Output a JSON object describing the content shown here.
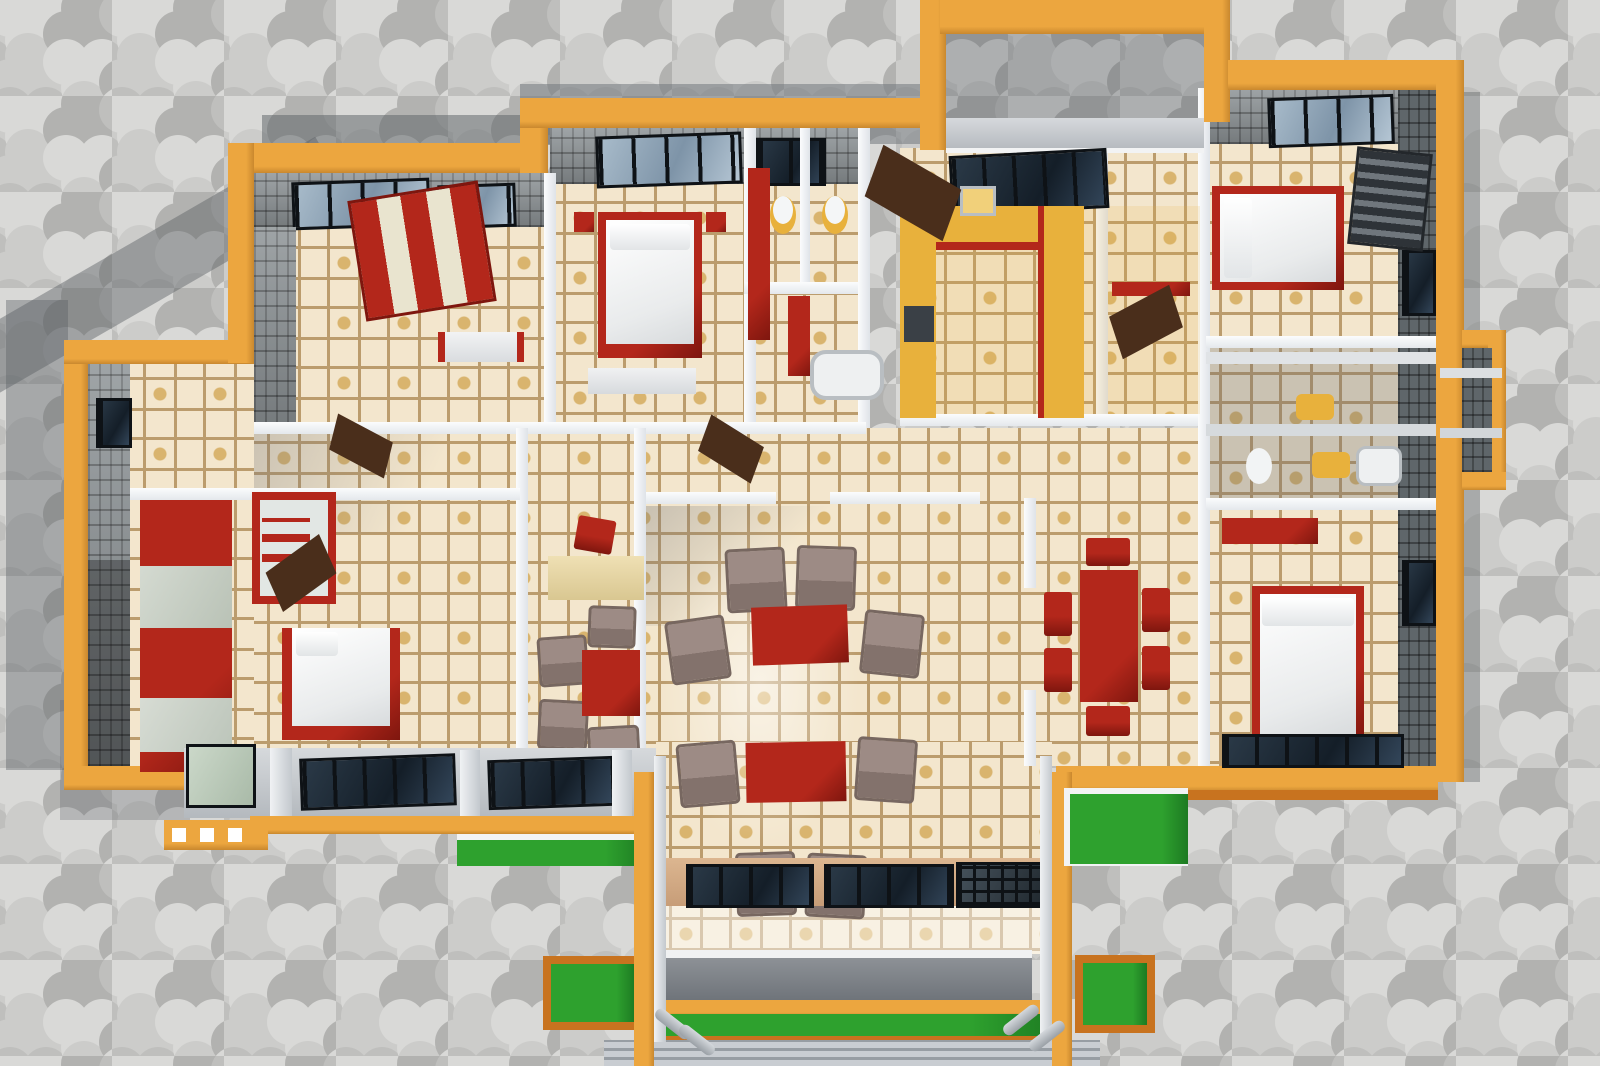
{
  "canvas": {
    "width": 1600,
    "height": 1066
  },
  "scene": {
    "kind": "3D architectural render, top-down cutaway floor plan of a bungalow",
    "background": "gray interlocking trefoil paver blocks with cast building shadow",
    "no_visible_text": true
  },
  "palette": {
    "paver_joint": "#9a9a98",
    "paver_1": "#d9d9d7",
    "paver_2": "#ccccca",
    "paver_3": "#bfbfbd",
    "paver_4": "#b2b2b0",
    "cap": "#eca63f",
    "cap_dark": "#c9882e",
    "burnt": "#c8731f",
    "brick": "#8f9598",
    "brick_dark": "#5f666a",
    "wall_white": "#f4f5f7",
    "tile_base": "#f3e6cd",
    "tile_line": "#bb9c6d",
    "tile_gold": "#d9b46e",
    "tile_dot": "#8a6c4a",
    "red": "#b3271b",
    "red_dark": "#7e160e",
    "taupe": "#9d8b85",
    "taupe_dark": "#83726c",
    "yellow": "#e8b13c",
    "grass": "#2ea12e",
    "grass_dark": "#1d7a22",
    "glass_steel": "#8fa3b4",
    "glass_dark": "#1d2a36",
    "frame": "#0e1216",
    "door": "#4a2e1b",
    "desk": "#efe0b4",
    "slab": "#c9ccd0"
  },
  "inventory": {
    "living_armchairs": 8,
    "living_coffee_tables": 2,
    "dining_table": 1,
    "dining_chairs": 6,
    "beds": 4,
    "wardrobes_red": 4,
    "wardrobe_striped": 1,
    "toilets": 3,
    "yellow_sinks": 3,
    "bathtubs": 2,
    "kitchen_counters": 3,
    "study_desk": 1,
    "study_table": 1,
    "study_chairs": 5,
    "lawn_patches": 5,
    "window_groups": 14,
    "doors_open": 6,
    "porch_columns": 4,
    "railing_balusters": 4
  }
}
